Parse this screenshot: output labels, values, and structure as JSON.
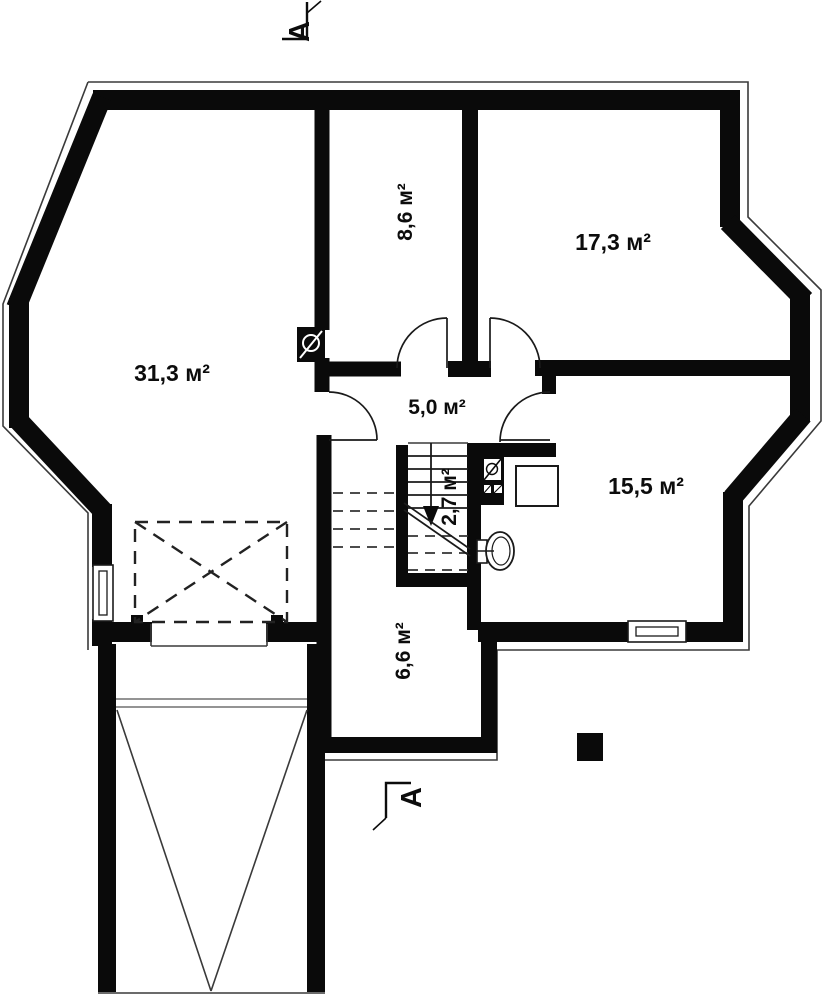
{
  "plan": {
    "type": "floor-plan",
    "section_markers": {
      "top_label": "А",
      "bottom_label": "А"
    },
    "rooms": {
      "living_room": {
        "area_label": "31,3 м²"
      },
      "room_top_mid": {
        "area_label": "8,6 м²"
      },
      "room_top_right": {
        "area_label": "17,3 м²"
      },
      "hallway": {
        "area_label": "5,0 м²"
      },
      "stairs": {
        "area_label": "2,7 м²"
      },
      "room_right": {
        "area_label": "15,5 м²"
      },
      "room_bottom": {
        "area_label": "6,6 м²"
      }
    },
    "colors": {
      "wall": "#0a0a0a",
      "background": "#ffffff",
      "dashed": "#222222"
    }
  }
}
